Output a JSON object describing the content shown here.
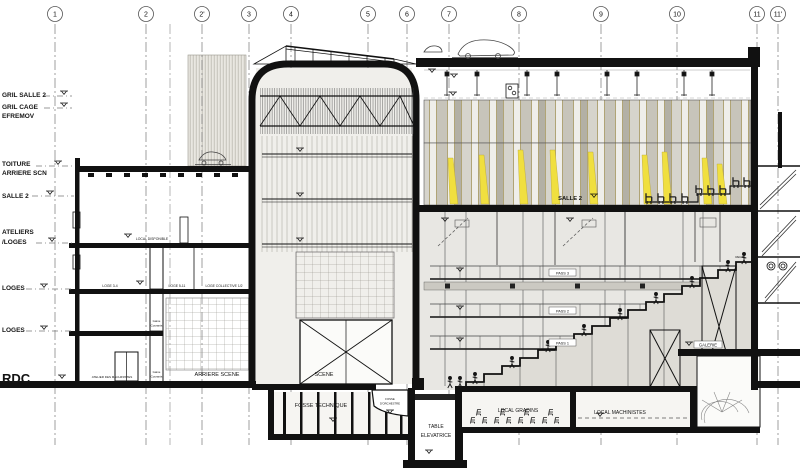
{
  "grid": {
    "labels": [
      "1",
      "2",
      "2'",
      "3",
      "4",
      "5",
      "6",
      "7",
      "8",
      "9",
      "10",
      "11",
      "11'"
    ]
  },
  "levels": [
    "GRIL SALLE 2",
    "GRIL CAGE",
    "EFREMOV",
    "TOITURE",
    "ARRIERE SCN",
    "SALLE 2",
    "ATELIERS",
    "/LOGES",
    "LOGES",
    "LOGES",
    "RDC"
  ],
  "rooms": {
    "local_disponible": "LOCAL DISPONIBLE",
    "loge_34": "LOGE 3-4",
    "loge_511": "LOGE 5-11",
    "loge_collective": "LOGE COLLECTIVE 1/2",
    "gaine_1a": "Gaine",
    "gaine_1b": "Courants",
    "gaine_2a": "Gaine",
    "gaine_2b": "Courants",
    "atelier_machinistes": "ATELIER DES MACHINISTES",
    "arriere_scene": "ARRIERE SCENE",
    "scene": "SCENE",
    "fosse_technique": "FOSSE TECHNIQUE",
    "fosse_orchestre_1": "FOSSE",
    "fosse_orchestre_2": "D'ORCHESTRE",
    "table_elevatrice_1": "TABLE",
    "table_elevatrice_2": "ELEVATRICE",
    "local_gradins": "LOCAL GRADINS",
    "local_machinistes": "LOCAL MACHINISTES",
    "salle2": "SALLE 2",
    "pass3": "PASS 3",
    "pass2": "PASS 2",
    "pass1": "PASS 1",
    "galerie": "GALERIE",
    "regie": "REGIE"
  },
  "colors": {
    "accent_yellow": "#f0df3f",
    "ink": "#141414",
    "paper": "#ffffff",
    "wall_gray": "#cbc9c2"
  }
}
